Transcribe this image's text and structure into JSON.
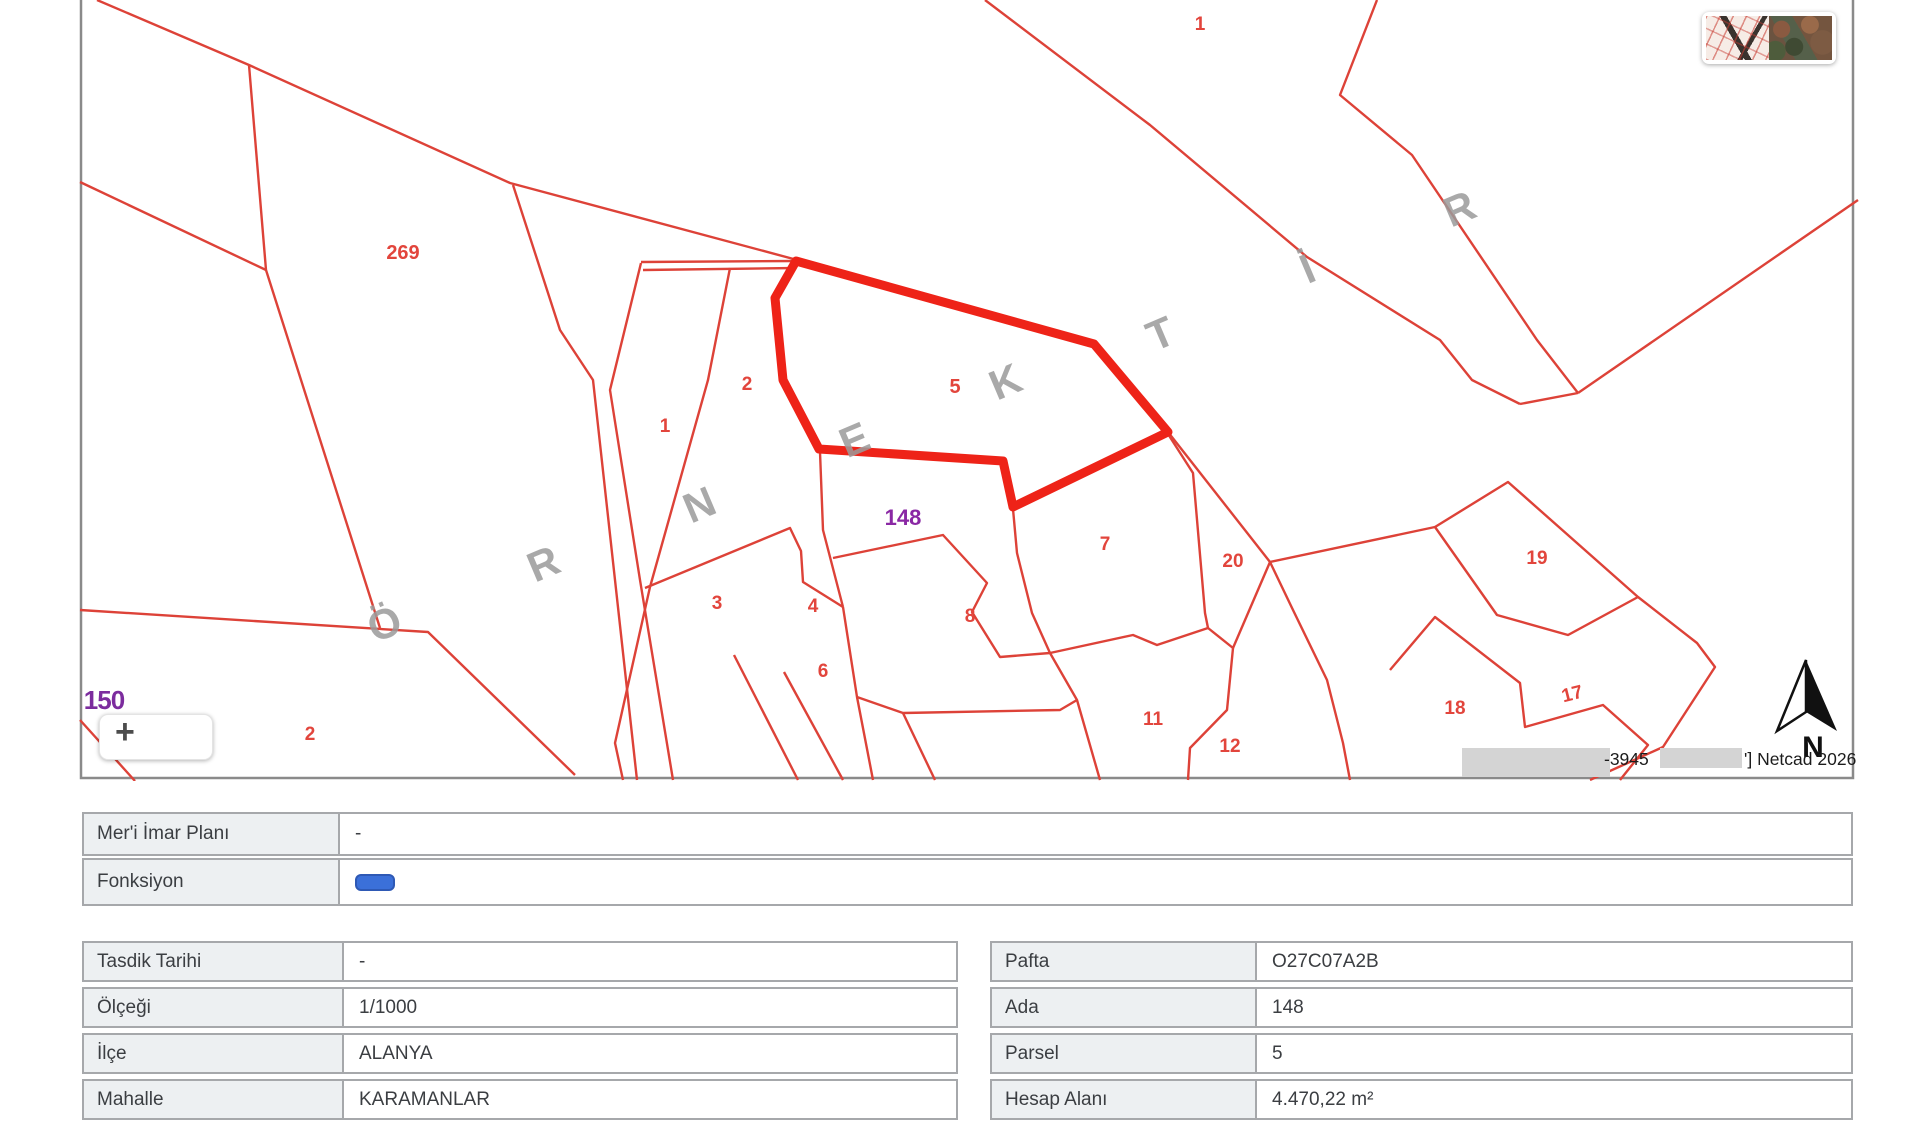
{
  "map": {
    "labels": {
      "l269": "269",
      "l1": "1",
      "l2": "2",
      "l2_bottom_left": "2",
      "l3": "3",
      "l4": "4",
      "l5": "5",
      "l6": "6",
      "l7": "7",
      "l8": "8",
      "l11": "11",
      "l12": "12",
      "l17": "17",
      "l18": "18",
      "l19": "19",
      "l20": "20",
      "l1_top_right": "1",
      "ada": "148",
      "ada_150": "150"
    },
    "watermark_letters": [
      "Ö",
      "R",
      "N",
      "E",
      "K",
      "T",
      "İ",
      "R"
    ],
    "north": "N",
    "zoom_in": "+",
    "attribution": {
      "coord_fragment": "-3945",
      "netcad": "'] Netcad 2026"
    }
  },
  "tables": {
    "plan": {
      "rows": [
        {
          "label": "Mer'i İmar Planı",
          "value": "-"
        },
        {
          "label": "Fonksiyon",
          "value": ""
        }
      ]
    },
    "left": {
      "rows": [
        {
          "label": "Tasdik Tarihi",
          "value": "-"
        },
        {
          "label": "Ölçeği",
          "value": "1/1000"
        },
        {
          "label": "İlçe",
          "value": "ALANYA"
        },
        {
          "label": "Mahalle",
          "value": "KARAMANLAR"
        }
      ]
    },
    "right": {
      "rows": [
        {
          "label": "Pafta",
          "value": "O27C07A2B"
        },
        {
          "label": "Ada",
          "value": "148"
        },
        {
          "label": "Parsel",
          "value": "5"
        },
        {
          "label": "Hesap Alanı",
          "value": "4.470,22 m²"
        }
      ]
    }
  },
  "colors": {
    "parcel_line": "#dd4238",
    "highlight": "#ee2318",
    "ada_label": "#8a28a4",
    "watermark": "#9b9b9b",
    "badge_blue": "#3b70d9",
    "table_border": "#a6a8ab"
  }
}
